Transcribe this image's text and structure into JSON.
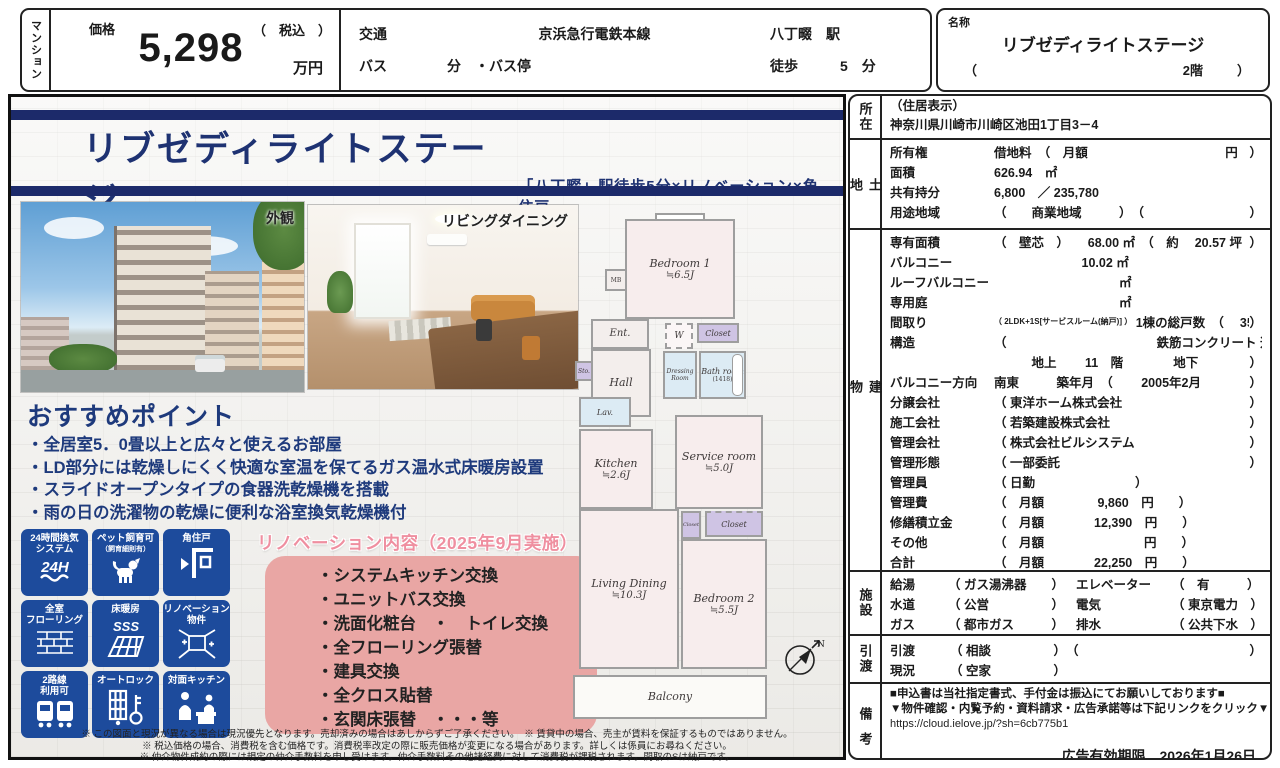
{
  "colors": {
    "navy": "#1c2a6a",
    "badge_blue": "#1d4b9c",
    "pink_box": "#e9a6a4",
    "pink_title": "#ef8fa0",
    "title_navy": "#1e3272"
  },
  "header": {
    "property_type": "マンション",
    "price": {
      "label": "価格",
      "value": "5,298",
      "tax": "（　税込　）",
      "unit": "万円"
    },
    "transport": {
      "label": "交通",
      "line": "京浜急行電鉄本線",
      "station": "八丁畷　駅",
      "bus_label": "バス",
      "bus_text": "分　・バス停",
      "walk": "徒歩　　　5　分"
    },
    "name": {
      "label": "名称",
      "value": "リブゼディライトステージ",
      "paren_open": "（",
      "floor": "2階",
      "paren_close": "）"
    }
  },
  "main": {
    "title": "リブゼディライトステージ",
    "subtitle": "「八丁畷」駅徒歩5分×リノベーション×角住戸",
    "photos": [
      {
        "label": "外観"
      },
      {
        "label": "リビングダイニング"
      }
    ],
    "points": {
      "title": "おすすめポイント",
      "items": [
        "・全居室5．0畳以上と広々と使えるお部屋",
        "・LD部分には乾燥しにくく快適な室温を保てるガス温水式床暖房設置",
        "・スライドオープンタイプの食器洗乾燥機を搭載",
        "・雨の日の洗濯物の乾燥に便利な浴室換気乾燥機付"
      ]
    },
    "badges": [
      {
        "l1": "24時間換気",
        "l2": "システム",
        "glyph": "24H",
        "icon": "ventilation-24h-icon"
      },
      {
        "l1": "ペット飼育可",
        "l2": "（飼育細則有）",
        "glyph": "",
        "icon": "pet-allowed-icon"
      },
      {
        "l1": "角住戸",
        "l2": "",
        "glyph": "",
        "icon": "corner-unit-icon"
      },
      {
        "l1": "全室",
        "l2": "フローリング",
        "glyph": "",
        "icon": "flooring-icon"
      },
      {
        "l1": "床暖房",
        "l2": "",
        "glyph": "SSS",
        "icon": "floor-heating-icon"
      },
      {
        "l1": "リノベーション",
        "l2": "物件",
        "glyph": "",
        "icon": "renovated-icon"
      },
      {
        "l1": "2路線",
        "l2": "利用可",
        "glyph": "",
        "icon": "two-lines-icon"
      },
      {
        "l1": "オートロック",
        "l2": "",
        "glyph": "",
        "icon": "autolock-icon"
      },
      {
        "l1": "対面キッチン",
        "l2": "",
        "glyph": "",
        "icon": "counter-kitchen-icon"
      }
    ],
    "renovation": {
      "title": "リノベーション内容（2025年9月実施）",
      "items": [
        "・システムキッチン交換",
        "・ユニットバス交換",
        "・洗面化粧台　・　トイレ交換",
        "・全フローリング張替",
        "・建具交換",
        "・全クロス貼替",
        "・玄関床張替　・・・等"
      ]
    },
    "fineprint": [
      "※ この図面と現況が異なる場合は現況優先となります。売却済みの場合はあしからずご了承ください。　※ 賃貸中の場合、売主が賃料を保証するものではありません。",
      "※ 税込価格の場合、消費税を含む価格です。消費税率改定の際に販売価格が変更になる場合があります。詳しくは係員にお尋ねください。",
      "※ 仲介物件成約の際には規定の仲介手数料を申し受けます。仲介手数料その他諸経費に対して消費税が課税されます。間取のSは納戸です。"
    ]
  },
  "floorplan": {
    "bedroom1": {
      "name": "Bedroom 1",
      "size": "≒6.5J"
    },
    "bedroom2": {
      "name": "Bedroom 2",
      "size": "≒5.5J"
    },
    "living": {
      "name": "Living Dining",
      "size": "≒10.3J"
    },
    "kitchen": {
      "name": "Kitchen",
      "size": "≒2.6J"
    },
    "service": {
      "name": "Service room",
      "size": "≒5.0J"
    },
    "bath": {
      "name": "Bath room",
      "size": "(1418)"
    },
    "dressing": "Dressing Room",
    "ent": "Ent.",
    "hall": "Hall",
    "lav": "Lav.",
    "sto": "Sto.",
    "w": "W",
    "mb": "MB",
    "closet1": "Closet",
    "closet2": "Closet",
    "closet3": "Closet",
    "balcony": "Balcony",
    "compass_n": "N"
  },
  "details": {
    "location": {
      "label": "所在",
      "line1": "（住居表示）",
      "line2": "神奈川県川崎市川崎区池田1丁目3－4"
    },
    "land": {
      "label": "土地",
      "rows": [
        {
          "l": "所有権",
          "sm": "",
          "v": "借地料　（　月額　　　　　　　　　　　円",
          "e": "）"
        },
        {
          "l": "面積",
          "sm": "",
          "v": "626.94　㎡",
          "e": ""
        },
        {
          "l": "共有持分",
          "sm": "",
          "v": "6,800　／ 235,780",
          "e": ""
        },
        {
          "l": "用途地域",
          "sm": "",
          "v": "（　　商業地域　　　）　（",
          "e": "）"
        }
      ]
    },
    "building": {
      "label": "建物",
      "rows": [
        {
          "l": "専有面積",
          "sm": "",
          "v": "（　壁芯　）　　68.00 ㎡　（　約　 20.57 坪",
          "e": "）"
        },
        {
          "l": "バルコニー",
          "sm": "",
          "v": "　　　　　　　10.02 ㎡",
          "e": ""
        },
        {
          "l": "ルーフバルコニー",
          "sm": "",
          "v": "　　　　　　　　　　㎡",
          "e": ""
        },
        {
          "l": "専用庭",
          "sm": "",
          "v": "　　　　　　　　　　㎡",
          "e": ""
        },
        {
          "l": "間取り",
          "sm": "（ 2LDK+1S[サービスルーム(納戸)] ）",
          "v": " 1棟の総戸数　（　 35　戸",
          "e": "）"
        },
        {
          "l": "構造",
          "sm": "",
          "v": "（　　　　　　　　　　　　鉄筋コンクリート 造",
          "e": ""
        },
        {
          "l": "",
          "sm": "",
          "v": "　　　地上　　 11　階　　　　地下　　　　　階建",
          "e": "）"
        },
        {
          "l": "バルコニー方向",
          "sm": "",
          "v": "南東　　　築年月　（　　 2005年2月",
          "e": "）"
        },
        {
          "l": "分譲会社",
          "sm": "",
          "v": "（ 東洋ホーム株式会社",
          "e": "）"
        },
        {
          "l": "施工会社",
          "sm": "",
          "v": "（ 若築建設株式会社",
          "e": "）"
        },
        {
          "l": "管理会社",
          "sm": "",
          "v": "（ 株式会社ビルシステム",
          "e": "）"
        },
        {
          "l": "管理形態",
          "sm": "",
          "v": "（ 一部委託",
          "e": "）"
        },
        {
          "l": "管理員",
          "sm": "",
          "v": "（ 日勤　　　　　　　　）",
          "e": ""
        },
        {
          "l": "管理費",
          "sm": "",
          "v": "（　月額　　　　 9,860　円　　）",
          "e": ""
        },
        {
          "l": "修繕積立金",
          "sm": "",
          "v": "（　月額　　　　12,390　円　　）",
          "e": ""
        },
        {
          "l": "その他",
          "sm": "",
          "v": "（　月額　　　　　　　　円　　）",
          "e": ""
        },
        {
          "l": "合計",
          "sm": "",
          "v": "（　月額　　　　22,250　円　　）",
          "e": ""
        }
      ]
    },
    "facilities": {
      "label": "施設",
      "rows": [
        {
          "l": "給湯",
          "v": "（ ガス湯沸器　　）",
          "l2": "エレベーター",
          "v2": "（　有　　　）"
        },
        {
          "l": "水道",
          "v": "（ 公営　　　　　）",
          "l2": "電気",
          "v2": "（ 東京電力　）"
        },
        {
          "l": "ガス",
          "v": "（ 都市ガス　　　）",
          "l2": "排水",
          "v2": "（ 公共下水　）"
        }
      ]
    },
    "handover": {
      "label": "引渡",
      "rows": [
        {
          "l": "引渡",
          "sm": "",
          "v": "（ 相談　　　　　）　（",
          "e": "）"
        },
        {
          "l": "現況",
          "sm": "",
          "v": "（ 空家　　　　　）",
          "e": ""
        }
      ]
    },
    "remarks": {
      "label": "備考",
      "line1": "■申込書は当社指定書式、手付金は振込にてお願いしております■",
      "line2": "▼物件確認・内覧予約・資料請求・広告承諾等は下記リンクをクリック▼",
      "url": "https://cloud.ielove.jp/?sh=6cb775b1",
      "expiry_label": "広告有効期限",
      "expiry_date": "2026年1月26日"
    }
  }
}
